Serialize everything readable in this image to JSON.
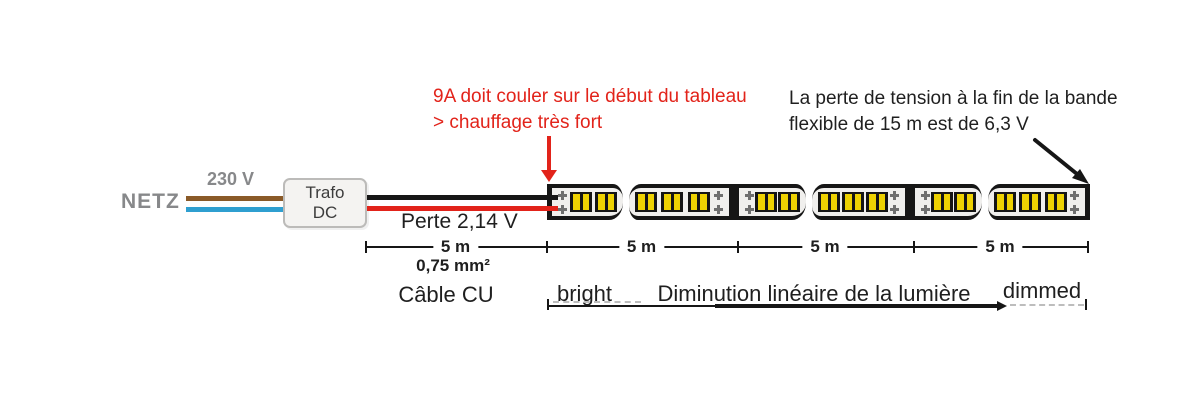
{
  "palette": {
    "red": "#e2231a",
    "gray_text": "#87888a",
    "brown_wire": "#8a5a28",
    "blue_wire": "#2f9fd0",
    "black": "#161616",
    "pad_gray": "#6f6f6f",
    "led_yellow": "#eed202",
    "strip_bg": "#f0efed"
  },
  "annotations": {
    "overload": {
      "line1": "9A doit couler sur le début du tableau",
      "line2": "> chauffage très fort"
    },
    "voltage_drop": {
      "line1": "La perte de tension à la fin de la bande",
      "line2": "flexible de 15 m est de 6,3 V"
    }
  },
  "mains": {
    "label": "NETZ",
    "voltage": "230 V"
  },
  "transformer": {
    "line1": "Trafo",
    "line2": "DC"
  },
  "cable": {
    "loss_label": "Perte 2,14 V",
    "cross_section": "0,75 mm²",
    "type_label": "Câble CU"
  },
  "dimension_labels": [
    "5 m",
    "5 m",
    "5 m",
    "5 m"
  ],
  "dimming": {
    "start_label": "bright",
    "middle_label": "Diminution linéaire de la lumière",
    "end_label": "dimmed"
  },
  "strip": {
    "pieces": [
      {
        "leds": 2,
        "pads": "left"
      },
      {
        "leds": 3,
        "pads": "right"
      },
      {
        "leds": 2,
        "pads": "left"
      },
      {
        "leds": 3,
        "pads": "right"
      },
      {
        "leds": 2,
        "pads": "left"
      },
      {
        "leds": 3,
        "pads": "right"
      }
    ]
  }
}
